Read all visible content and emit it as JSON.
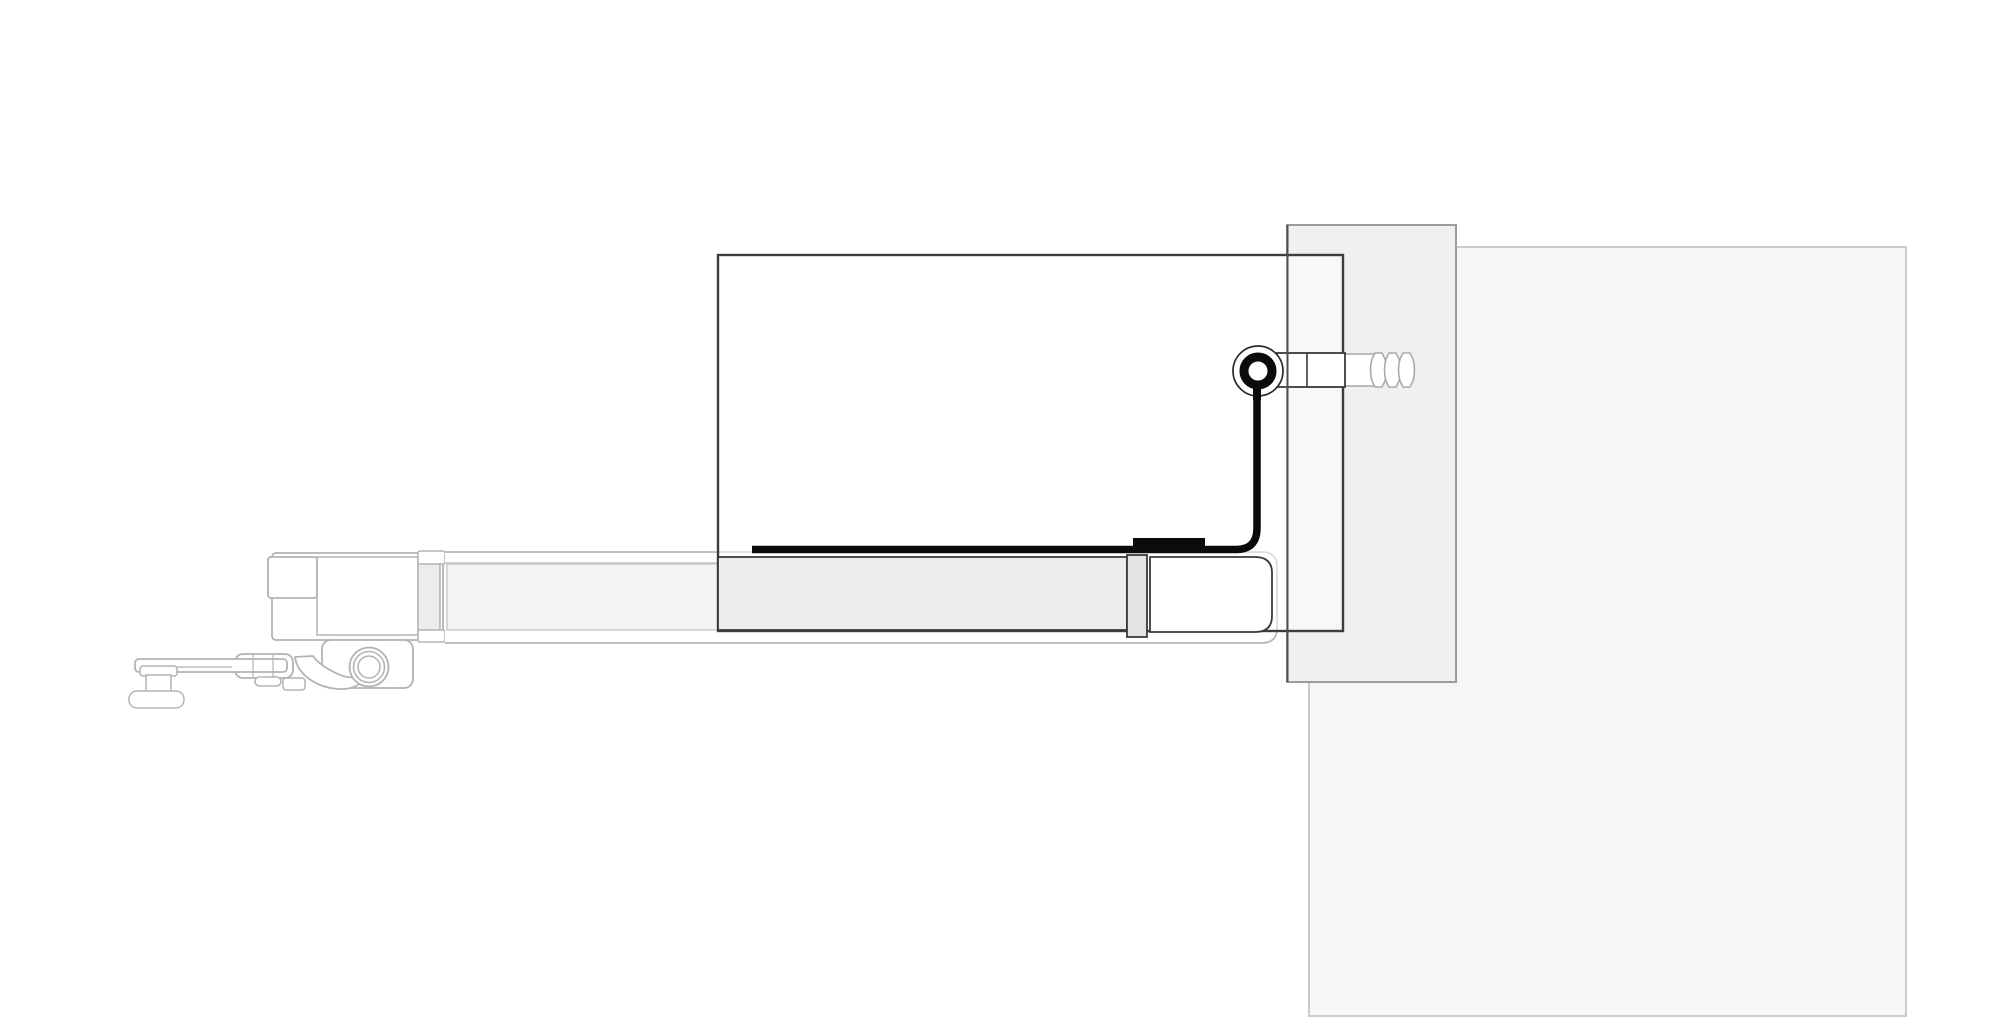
{
  "meta": {
    "title": "door-pivot-section-drawing",
    "viewbox": "0 0 2000 1024",
    "background": "#ffffff"
  },
  "palette": {
    "black": "#0b0b0b",
    "outline_dark": "#3a3a3a",
    "outline_mid": "#9c9c9c",
    "outline_light": "#b3b3b3",
    "wall_large_fill": "#f6f6f6",
    "wall_jamb_fill": "#f0f0f0",
    "rail_left_fill": "#f4f4f4",
    "channel_fill": "#ececec",
    "divider_fill": "#e3e3e3"
  },
  "drawing": {
    "elements": [
      {
        "name": "wall-panel-large",
        "tag": "rect",
        "attrs": {
          "x": 1309,
          "y": 247,
          "width": 597,
          "height": 769,
          "fill": "#f6f6f6",
          "stroke": "#cbcbcb",
          "stroke-width": 2
        }
      },
      {
        "name": "wall-jamb",
        "tag": "rect",
        "attrs": {
          "x": 1287,
          "y": 225,
          "width": 169,
          "height": 457,
          "fill": "#f0f0f0",
          "stroke": "#9c9c9c",
          "stroke-width": 2
        }
      },
      {
        "name": "carriage-block-main",
        "tag": "rect",
        "attrs": {
          "x": 272,
          "y": 553,
          "width": 171,
          "height": 87,
          "rx": 4,
          "fill": "#ffffff",
          "stroke": "#b3b3b3",
          "stroke-width": 1.8
        }
      },
      {
        "name": "carriage-cavity",
        "tag": "rect",
        "attrs": {
          "x": 317,
          "y": 557,
          "width": 101,
          "height": 78,
          "fill": "#ffffff",
          "stroke": "#b3b3b3",
          "stroke-width": 1.5
        }
      },
      {
        "name": "carriage-box-small",
        "tag": "rect",
        "attrs": {
          "x": 268,
          "y": 557,
          "width": 49,
          "height": 41,
          "rx": 3,
          "fill": "#ffffff",
          "stroke": "#b3b3b3",
          "stroke-width": 1.8
        }
      },
      {
        "name": "carriage-clip-strip",
        "tag": "rect",
        "attrs": {
          "x": 418,
          "y": 558,
          "width": 22,
          "height": 82,
          "fill": "#ececec",
          "stroke": "#b3b3b3",
          "stroke-width": 1.5
        }
      },
      {
        "name": "carriage-clip-top",
        "tag": "rect",
        "attrs": {
          "x": 418,
          "y": 551,
          "width": 27,
          "height": 13,
          "rx": 2,
          "fill": "#ffffff",
          "stroke": "#b3b3b3",
          "stroke-width": 1.5
        }
      },
      {
        "name": "carriage-clip-bottom",
        "tag": "rect",
        "attrs": {
          "x": 418,
          "y": 630,
          "width": 27,
          "height": 12,
          "rx": 2,
          "fill": "#ffffff",
          "stroke": "#b3b3b3",
          "stroke-width": 1.5
        }
      },
      {
        "name": "carriage-plate",
        "tag": "rect",
        "attrs": {
          "x": 322,
          "y": 640,
          "width": 91,
          "height": 48,
          "rx": 9,
          "fill": "#ffffff",
          "stroke": "#b3b3b3",
          "stroke-width": 1.8
        }
      },
      {
        "name": "trolley-arm-block",
        "tag": "rect",
        "attrs": {
          "x": 235,
          "y": 654,
          "width": 58,
          "height": 24,
          "rx": 8,
          "fill": "#ffffff",
          "stroke": "#b3b3b3",
          "stroke-width": 1.8
        }
      },
      {
        "name": "trolley-arm",
        "tag": "rect",
        "attrs": {
          "x": 135,
          "y": 659,
          "width": 152,
          "height": 13,
          "rx": 4,
          "fill": "#ffffff",
          "stroke": "#b3b3b3",
          "stroke-width": 1.8
        }
      },
      {
        "name": "trolley-arm-line",
        "tag": "line",
        "attrs": {
          "x1": 140,
          "y1": 667,
          "x2": 232,
          "y2": 667,
          "stroke": "#b3b3b3",
          "stroke-width": 1.2
        }
      },
      {
        "name": "arm-joint-line-a",
        "tag": "line",
        "attrs": {
          "x1": 253,
          "y1": 655,
          "x2": 253,
          "y2": 677,
          "stroke": "#b3b3b3",
          "stroke-width": 1.2
        }
      },
      {
        "name": "arm-joint-line-b",
        "tag": "line",
        "attrs": {
          "x1": 273,
          "y1": 655,
          "x2": 273,
          "y2": 677,
          "stroke": "#b3b3b3",
          "stroke-width": 1.2
        }
      },
      {
        "name": "arm-nub",
        "tag": "rect",
        "attrs": {
          "x": 255,
          "y": 677,
          "width": 26,
          "height": 9,
          "rx": 4.5,
          "fill": "#ffffff",
          "stroke": "#b3b3b3",
          "stroke-width": 1.5
        }
      },
      {
        "name": "arm-foot",
        "tag": "rect",
        "attrs": {
          "x": 283,
          "y": 678,
          "width": 22,
          "height": 12,
          "rx": 3,
          "fill": "#ffffff",
          "stroke": "#b3b3b3",
          "stroke-width": 1.5
        }
      },
      {
        "name": "latch-hook",
        "tag": "path",
        "attrs": {
          "d": "M295 657 C297 673 314 687 338 689 C352 690 364 684 368 674 C360 678 348 679 338 674 C325 668 317 662 313 656 Z",
          "fill": "#ffffff",
          "stroke": "#b3b3b3",
          "stroke-width": 1.8,
          "stroke-linejoin": "round"
        }
      },
      {
        "name": "roller-flange",
        "tag": "rect",
        "attrs": {
          "x": 140,
          "y": 666,
          "width": 37,
          "height": 10,
          "rx": 3,
          "fill": "#ffffff",
          "stroke": "#b3b3b3",
          "stroke-width": 1.5
        }
      },
      {
        "name": "roller-waist",
        "tag": "rect",
        "attrs": {
          "x": 146,
          "y": 675,
          "width": 25,
          "height": 18,
          "fill": "#ffffff",
          "stroke": "#b3b3b3",
          "stroke-width": 1.5
        }
      },
      {
        "name": "roller-base",
        "tag": "rect",
        "attrs": {
          "x": 129,
          "y": 691,
          "width": 55,
          "height": 17,
          "rx": 8,
          "fill": "#ffffff",
          "stroke": "#b3b3b3",
          "stroke-width": 1.5
        }
      },
      {
        "name": "wheel-ring-outer",
        "tag": "circle",
        "attrs": {
          "cx": 369,
          "cy": 667,
          "r": 19.5,
          "fill": "#ffffff",
          "stroke": "#b3b3b3",
          "stroke-width": 1.8
        }
      },
      {
        "name": "wheel-ring-mid",
        "tag": "circle",
        "attrs": {
          "cx": 369,
          "cy": 667,
          "r": 15.5,
          "fill": "none",
          "stroke": "#b3b3b3",
          "stroke-width": 1.5
        }
      },
      {
        "name": "wheel-ring-inner",
        "tag": "circle",
        "attrs": {
          "cx": 369,
          "cy": 667,
          "r": 11,
          "fill": "#ffffff",
          "stroke": "#b3b3b3",
          "stroke-width": 1.5
        }
      },
      {
        "name": "rail-shell",
        "tag": "path",
        "attrs": {
          "d": "M445 552 H1261 Q1277 552 1277 566 V629 Q1277 643 1261 643 H445",
          "fill": "#ffffff",
          "stroke": "#b8b8b8",
          "stroke-width": 1.8
        }
      },
      {
        "name": "rail-top-line",
        "tag": "line",
        "attrs": {
          "x1": 445,
          "y1": 563,
          "x2": 718,
          "y2": 563,
          "stroke": "#c2c2c2",
          "stroke-width": 1.4
        }
      },
      {
        "name": "rail-left-fill",
        "tag": "rect",
        "attrs": {
          "x": 447,
          "y": 564,
          "width": 271,
          "height": 66,
          "fill": "#f4f4f4",
          "stroke": "#c6c6c6",
          "stroke-width": 1.4
        }
      },
      {
        "name": "glass-panel",
        "tag": "rect",
        "attrs": {
          "x": 718,
          "y": 255,
          "width": 625,
          "height": 376,
          "fill": "rgba(255,255,255,0.5)",
          "stroke": "#3d3d3d",
          "stroke-width": 2.4
        }
      },
      {
        "name": "glazing-channel",
        "tag": "rect",
        "attrs": {
          "x": 718,
          "y": 557,
          "width": 409,
          "height": 73,
          "fill": "#ececec",
          "stroke": "#3a3a3a",
          "stroke-width": 1.8
        }
      },
      {
        "name": "channel-divider",
        "tag": "rect",
        "attrs": {
          "x": 1127,
          "y": 555,
          "width": 20,
          "height": 82,
          "fill": "#e3e3e3",
          "stroke": "#3a3a3a",
          "stroke-width": 1.8
        }
      },
      {
        "name": "rail-end-cap",
        "tag": "path",
        "attrs": {
          "d": "M1150 557 H1255 Q1272 557 1272 573 V616 Q1272 632 1255 632 H1150 Z",
          "fill": "#ffffff",
          "stroke": "#3a3a3a",
          "stroke-width": 1.8
        }
      },
      {
        "name": "pivot-bolt-rod-rear",
        "tag": "rect",
        "attrs": {
          "x": 1344,
          "y": 354,
          "width": 30,
          "height": 32,
          "fill": "#ffffff",
          "stroke": "#ababab",
          "stroke-width": 1.6
        }
      },
      {
        "name": "bolt-thread-1",
        "tag": "path",
        "attrs": {
          "d": "M1375 353 H1382 L1385 359 Q1388 370 1385 381 L1382 387 H1375 L1372 381 Q1369 370 1372 359 Z",
          "fill": "#ffffff",
          "stroke": "#ababab",
          "stroke-width": 1.6
        }
      },
      {
        "name": "bolt-thread-2",
        "tag": "path",
        "attrs": {
          "d": "M1389 353 H1396 L1399 359 Q1402 370 1399 381 L1396 387 H1389 L1386 381 Q1383 370 1386 359 Z",
          "fill": "#ffffff",
          "stroke": "#ababab",
          "stroke-width": 1.6
        }
      },
      {
        "name": "bolt-thread-3",
        "tag": "path",
        "attrs": {
          "d": "M1403 353 H1410 L1413 359 Q1416 370 1413 381 L1410 387 H1403 L1400 381 Q1397 370 1400 359 Z",
          "fill": "#ffffff",
          "stroke": "#ababab",
          "stroke-width": 1.6
        }
      },
      {
        "name": "pivot-bolt-rod",
        "tag": "rect",
        "attrs": {
          "x": 1277,
          "y": 353,
          "width": 68,
          "height": 34,
          "fill": "#ffffff",
          "stroke": "#3a3a3a",
          "stroke-width": 1.8
        }
      },
      {
        "name": "bolt-rod-line",
        "tag": "line",
        "attrs": {
          "x1": 1307,
          "y1": 353,
          "x2": 1307,
          "y2": 387,
          "stroke": "#3a3a3a",
          "stroke-width": 1.6
        }
      },
      {
        "name": "jamb-front-edge",
        "tag": "line",
        "attrs": {
          "x1": 1287.5,
          "y1": 225,
          "x2": 1287.5,
          "y2": 682,
          "stroke": "#4f4f4f",
          "stroke-width": 2
        }
      },
      {
        "name": "seal-profile",
        "tag": "path",
        "attrs": {
          "d": "M752 549.5 H1236 Q1257 549.5 1257 528 V382",
          "fill": "none",
          "stroke": "#0b0b0b",
          "stroke-width": 7.5
        }
      },
      {
        "name": "seal-block",
        "tag": "rect",
        "attrs": {
          "x": 1133,
          "y": 538,
          "width": 72,
          "height": 10,
          "fill": "#0b0b0b"
        }
      },
      {
        "name": "pivot-ring-outer",
        "tag": "circle",
        "attrs": {
          "cx": 1258,
          "cy": 371,
          "r": 25,
          "fill": "#ffffff",
          "stroke": "#2b2b2b",
          "stroke-width": 1.7
        }
      },
      {
        "name": "pivot-stem",
        "tag": "rect",
        "attrs": {
          "x": 1253,
          "y": 378,
          "width": 8,
          "height": 22,
          "fill": "#0b0b0b"
        }
      },
      {
        "name": "pivot-ring",
        "tag": "circle",
        "attrs": {
          "cx": 1258,
          "cy": 371,
          "r": 14,
          "fill": "#ffffff",
          "stroke": "#0b0b0b",
          "stroke-width": 9
        }
      }
    ]
  }
}
